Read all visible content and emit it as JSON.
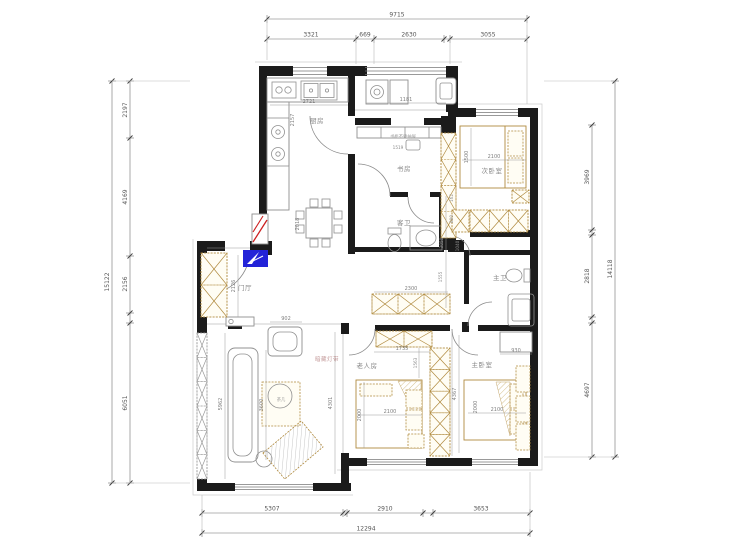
{
  "dimensions": {
    "top": {
      "total": "9715",
      "segments": [
        "3321",
        "669",
        "2630",
        "3055"
      ]
    },
    "left": {
      "total": "15122",
      "segments": [
        "2197",
        "4169",
        "2156",
        "6051"
      ]
    },
    "right": {
      "total": "14118",
      "segments": [
        "3969",
        "2818",
        "4697"
      ]
    },
    "bottom": {
      "total": "12294",
      "segments": [
        "5307",
        "2910",
        "3653"
      ]
    }
  },
  "rooms": {
    "kitchen": "厨房",
    "study": "书房",
    "second_bedroom": "次卧室",
    "guest_bath": "客卫",
    "master_bath": "主卫",
    "foyer": "门厅",
    "elder_room": "老人房",
    "master_bedroom": "主卧室"
  },
  "annotations": {
    "bookcase_note": "书柜不要抽屉",
    "concealed_light": "暗藏灯带",
    "tea_table": "茶几"
  },
  "interior_dimensions": {
    "kitchen_counter": "2721",
    "kitchen_depth": "2157",
    "balcony": "1181",
    "kitchen_door": "1519",
    "hall_depth": "2018",
    "foyer_wardrobe": "2126",
    "armchair": "902",
    "sofa": "3600",
    "living_left": "5962",
    "living_right": "4301",
    "corridor_a": "3050",
    "corridor_b": "1555",
    "bath_a": "162",
    "bath_b": "800",
    "bath_c": "1040",
    "corridor_wardrobe": "2300",
    "bed2_w": "2100",
    "bed2_d": "1500",
    "elder_wardrobe": "1735",
    "elder_side": "1563",
    "elder_bed_w": "2100",
    "elder_bed_d": "2000",
    "master_desk": "930",
    "master_side": "4367",
    "master_bed_w": "2100",
    "master_bed_d": "2000"
  },
  "colors": {
    "wall": "#1b1b1b",
    "wood": "#b08a3e",
    "dimension": "#6f6f6f",
    "entry_arrow": "#2323d8",
    "alert_red": "#cc2020",
    "label": "#8a8a8a",
    "light_note": "#c49a9a"
  }
}
